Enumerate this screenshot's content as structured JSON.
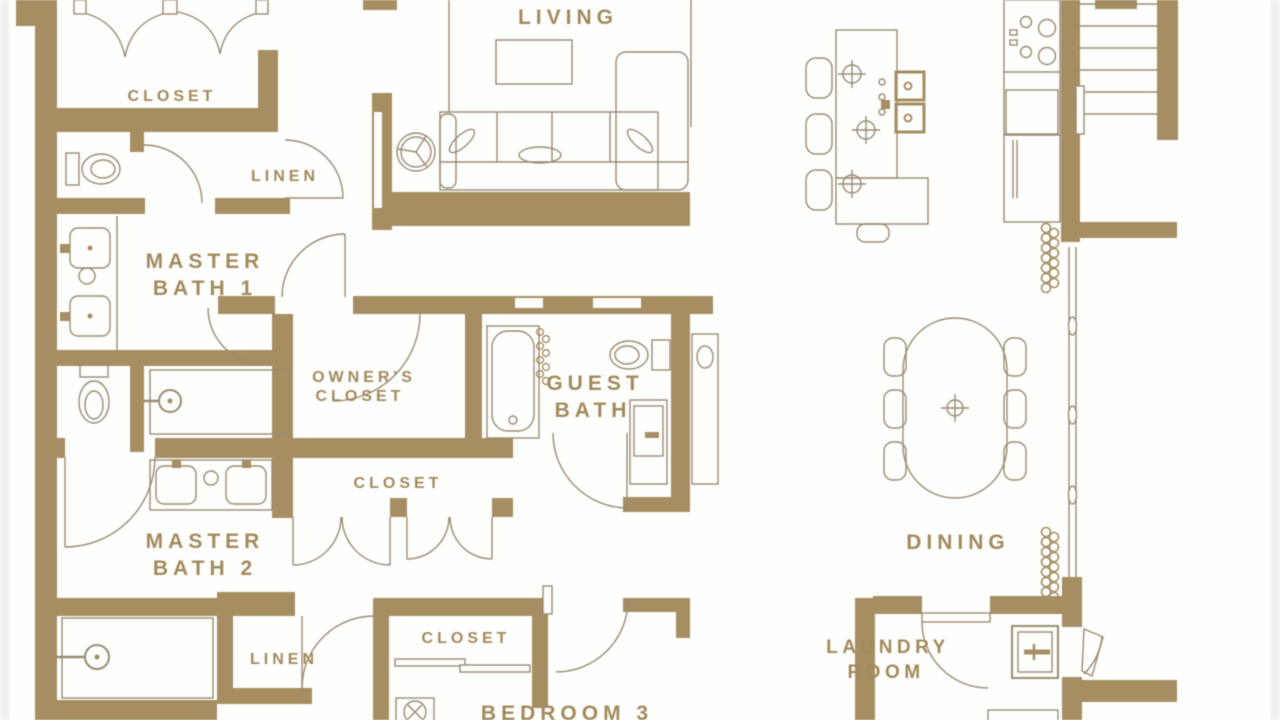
{
  "palette": {
    "wall": "#a68e62",
    "line": "#998b71",
    "label": "#a28a5c",
    "background": "#fefefd"
  },
  "rooms": {
    "living": {
      "label": "LIVING"
    },
    "closet_master1": {
      "label": "CLOSET"
    },
    "linen_upper": {
      "label": "LINEN"
    },
    "master_bath_1": {
      "line1": "MASTER",
      "line2": "BATH 1"
    },
    "owners_closet": {
      "line1": "OWNER'S",
      "line2": "CLOSET"
    },
    "guest_bath": {
      "line1": "GUEST",
      "line2": "BATH"
    },
    "closet_hall": {
      "label": "CLOSET"
    },
    "master_bath_2": {
      "line1": "MASTER",
      "line2": "BATH 2"
    },
    "linen_lower": {
      "label": "LINEN"
    },
    "closet_bedroom3": {
      "label": "CLOSET"
    },
    "bedroom_3": {
      "label": "BEDROOM 3"
    },
    "dining": {
      "label": "DINING"
    },
    "laundry_room": {
      "line1": "LAUNDRY",
      "line2": "ROOM"
    }
  }
}
